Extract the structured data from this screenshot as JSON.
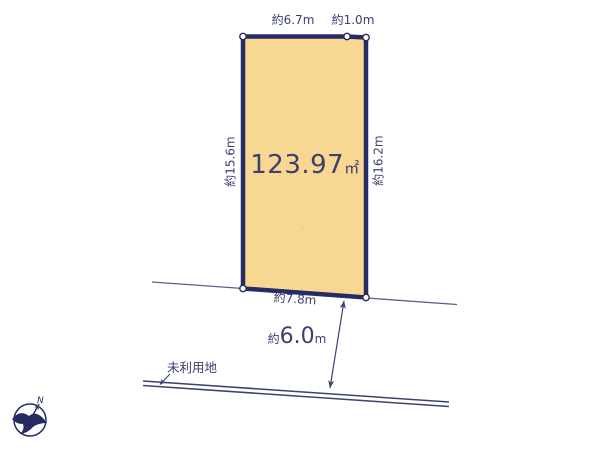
{
  "diagram": {
    "area": {
      "value": "123.97",
      "unit": "㎡"
    },
    "dimensions": {
      "top_width": "約6.7m",
      "top_offset": "約1.0m",
      "left_depth": "約15.6m",
      "right_depth": "約16.2m",
      "bottom_width": "約7.8m"
    },
    "road_distance": {
      "prefix": "約",
      "value": "6.0",
      "unit": "m"
    },
    "labels": {
      "unused_land": "未利用地"
    },
    "compass": {
      "north": "N"
    },
    "colors": {
      "plot_fill": "#F8D792",
      "plot_border": "#262C63",
      "text": "#3A4070",
      "thin_line": "#5A5F85",
      "road_line": "#3C4273"
    }
  }
}
